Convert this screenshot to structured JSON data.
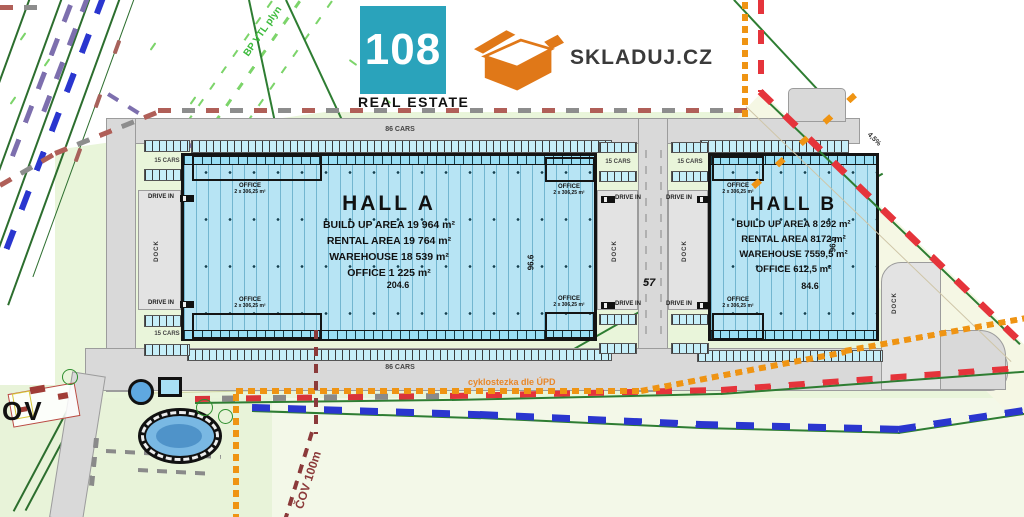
{
  "brand": {
    "logo_number": "108",
    "logo_name": "REAL ESTATE",
    "partner_name": "SKLADUJ.CZ"
  },
  "hall_a": {
    "title": "HALL A",
    "line1": "BUILD UP AREA 19 964 m²",
    "line2": "RENTAL AREA 19 764 m²",
    "line3": "WAREHOUSE 18 539 m²",
    "line4": "OFFICE 1 225 m²",
    "width_dim": "204.6",
    "depth_dim": "96.6"
  },
  "hall_b": {
    "title": "HALL B",
    "line1": "BUILD UP AREA 8 292 m²",
    "line2": "RENTAL AREA 8172 m²",
    "line3": "WAREHOUSE 7559,5 m²",
    "line4": "OFFICE 612,5 m²",
    "width_dim": "84.6",
    "depth_dim": "96.6"
  },
  "labels": {
    "parking_large": "86 CARS",
    "parking_small": "15 CARS",
    "drive_in": "DRIVE IN",
    "dock": "DOCK",
    "gap_dim": "57",
    "office": "OFFICE",
    "office_area": "2 x 306,25 m²",
    "cycle_path": "cyklostezka dle ÚPD",
    "cov_radius": "ČOV 100m",
    "gas_corridor": "BP VTL plyn",
    "slope": "4,5%",
    "village": "OV"
  },
  "colors": {
    "hall_fill": "#b7e4f4",
    "brand_teal": "#2aa3bb",
    "brand_orange": "#e07818",
    "boundary_red": "#e5343b",
    "boundary_muted": "#b05f58",
    "line_blue": "#2a36cf",
    "line_orange": "#ef9413",
    "line_green": "#2e7d32",
    "cov_red": "#8b3a3a"
  }
}
